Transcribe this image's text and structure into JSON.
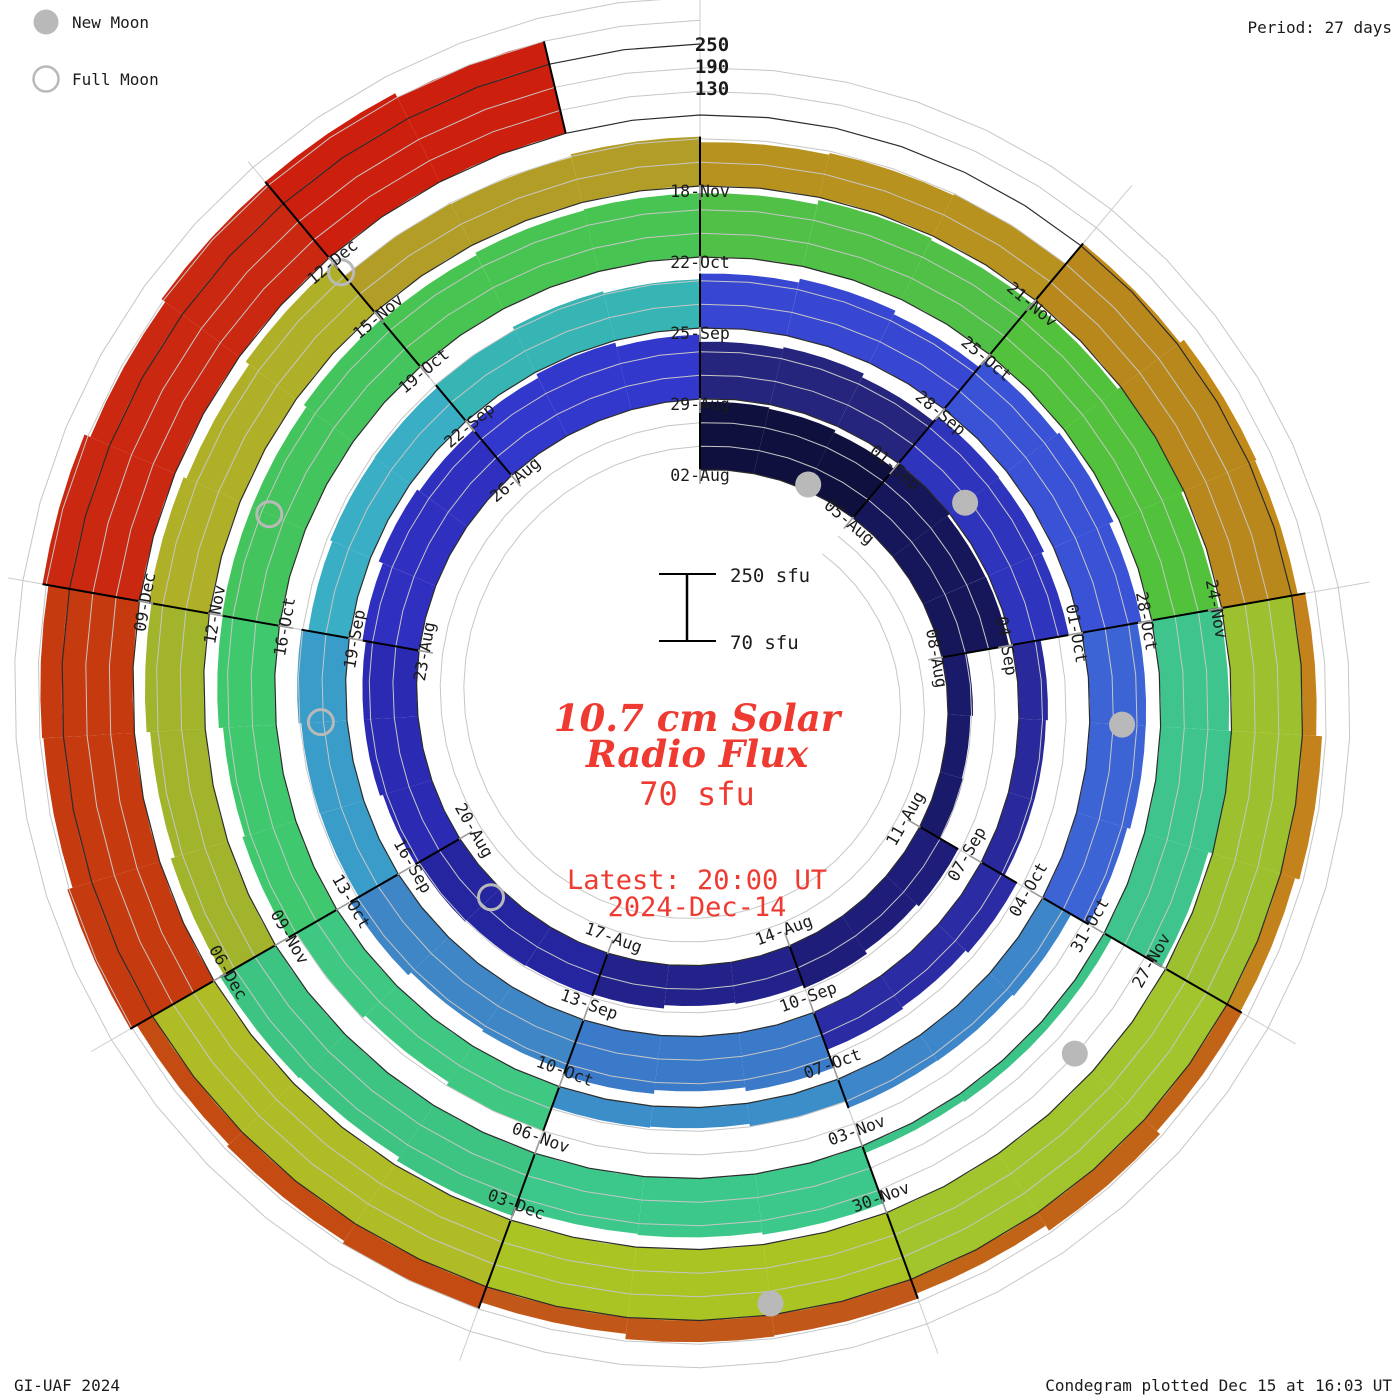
{
  "legend": {
    "new_moon_label": "New Moon",
    "full_moon_label": "Full Moon"
  },
  "period_label": "Period: 27 days",
  "radial_scale_labels": [
    "250",
    "190",
    "130"
  ],
  "scalebar": {
    "top_label": "250 sfu",
    "bottom_label": "70 sfu"
  },
  "center": {
    "title_line1": "10.7 cm Solar",
    "title_line2": "Radio Flux",
    "flux_value": "70 sfu",
    "latest_line1": "Latest: 20:00 UT",
    "latest_line2": "2024-Dec-14"
  },
  "footer": {
    "credit": "GI-UAF 2024",
    "plotted": "Condegram plotted Dec 15 at 16:03 UT"
  },
  "colors": {
    "text": "#1b1b1b",
    "red_text": "#ee3a31",
    "grid": "#c6c6c6",
    "baseline": "#2b2b2b",
    "separator": "#000000",
    "spoke": "#cccccc",
    "tick": "#9a9a9a",
    "moon": "#b9b9b9"
  },
  "chart_data": {
    "type": "bar",
    "subtype": "spiral-condegram",
    "title": "10.7 cm Solar Radio Flux",
    "period_days": 27,
    "days_per_block": 3,
    "start_date": "2024-08-02",
    "end_date": "2024-12-14",
    "flux_baseline_sfu": 70,
    "flux_gridlines_sfu": [
      130,
      190,
      250
    ],
    "layout": {
      "clockwise": true,
      "start_angle_deg": 0,
      "legend_position": "top-left",
      "grid": true
    },
    "blocks": [
      {
        "date": "02-Aug",
        "flux_sfu": 238,
        "color": "#10103e"
      },
      {
        "date": "05-Aug",
        "flux_sfu": 245,
        "color": "#16165a"
      },
      {
        "date": "08-Aug",
        "flux_sfu": 130,
        "color": "#1a1a6a"
      },
      {
        "date": "11-Aug",
        "flux_sfu": 180,
        "color": "#1e1e7a"
      },
      {
        "date": "14-Aug",
        "flux_sfu": 176,
        "color": "#22228a"
      },
      {
        "date": "17-Aug",
        "flux_sfu": 188,
        "color": "#2525a0"
      },
      {
        "date": "20-Aug",
        "flux_sfu": 205,
        "color": "#2a2ab2"
      },
      {
        "date": "23-Aug",
        "flux_sfu": 222,
        "color": "#2f2fc0"
      },
      {
        "date": "26-Aug",
        "flux_sfu": 238,
        "color": "#3338cc"
      },
      {
        "date": "29-Aug",
        "flux_sfu": 215,
        "color": "#25257e"
      },
      {
        "date": "01-Sep",
        "flux_sfu": 222,
        "color": "#2e34bc"
      },
      {
        "date": "04-Sep",
        "flux_sfu": 140,
        "color": "#29299c"
      },
      {
        "date": "07-Sep",
        "flux_sfu": 170,
        "color": "#2b2ba4"
      },
      {
        "date": "10-Sep",
        "flux_sfu": 215,
        "color": "#3a7ac8"
      },
      {
        "date": "13-Sep",
        "flux_sfu": 205,
        "color": "#3e86c6"
      },
      {
        "date": "16-Sep",
        "flux_sfu": 188,
        "color": "#3a9cc8"
      },
      {
        "date": "19-Sep",
        "flux_sfu": 180,
        "color": "#3aaec4"
      },
      {
        "date": "22-Sep",
        "flux_sfu": 194,
        "color": "#37b4b4"
      },
      {
        "date": "25-Sep",
        "flux_sfu": 212,
        "color": "#3747d2"
      },
      {
        "date": "28-Sep",
        "flux_sfu": 230,
        "color": "#3952d6"
      },
      {
        "date": "01-Oct",
        "flux_sfu": 210,
        "color": "#3c64d4"
      },
      {
        "date": "04-Oct",
        "flux_sfu": 150,
        "color": "#3e86ca"
      },
      {
        "date": "07-Oct",
        "flux_sfu": 125,
        "color": "#3c8ec8"
      },
      {
        "date": "10-Oct",
        "flux_sfu": 185,
        "color": "#3ec882"
      },
      {
        "date": "13-Oct",
        "flux_sfu": 210,
        "color": "#40c86e"
      },
      {
        "date": "16-Oct",
        "flux_sfu": 220,
        "color": "#44c45c"
      },
      {
        "date": "19-Oct",
        "flux_sfu": 228,
        "color": "#48c452"
      },
      {
        "date": "22-Oct",
        "flux_sfu": 238,
        "color": "#50c046"
      },
      {
        "date": "25-Oct",
        "flux_sfu": 246,
        "color": "#52c23c"
      },
      {
        "date": "28-Oct",
        "flux_sfu": 245,
        "color": "#3ec48c"
      },
      {
        "date": "31-Oct",
        "flux_sfu": 92,
        "color": "#3cc488"
      },
      {
        "date": "03-Nov",
        "flux_sfu": 220,
        "color": "#3cc88a"
      },
      {
        "date": "06-Nov",
        "flux_sfu": 232,
        "color": "#3ec482"
      },
      {
        "date": "09-Nov",
        "flux_sfu": 216,
        "color": "#a2b42c"
      },
      {
        "date": "12-Nov",
        "flux_sfu": 224,
        "color": "#b0b028"
      },
      {
        "date": "15-Nov",
        "flux_sfu": 190,
        "color": "#b29e26"
      },
      {
        "date": "18-Nov",
        "flux_sfu": 185,
        "color": "#b8921e"
      },
      {
        "date": "21-Nov",
        "flux_sfu": 265,
        "color": "#b8881c",
        "overflow_color": "#c28a18"
      },
      {
        "date": "24-Nov",
        "flux_sfu": 292,
        "color": "#9cc02e",
        "overflow_color": "#c4821c"
      },
      {
        "date": "27-Nov",
        "flux_sfu": 296,
        "color": "#a2c42c",
        "overflow_color": "#c26418"
      },
      {
        "date": "30-Nov",
        "flux_sfu": 300,
        "color": "#aac424",
        "overflow_color": "#c2571a"
      },
      {
        "date": "03-Dec",
        "flux_sfu": 302,
        "color": "#b0bc26",
        "overflow_color": "#c44c12"
      },
      {
        "date": "06-Dec",
        "flux_sfu": 306,
        "color": "#c63a10",
        "overflow_color": "#c63a10"
      },
      {
        "date": "09-Dec",
        "flux_sfu": 312,
        "color": "#ca2810",
        "overflow_color": "#ca2810"
      },
      {
        "date": "12-Dec",
        "flux_sfu": 318,
        "color": "#cc1f0e",
        "overflow_color": "#cc1f0e"
      }
    ],
    "moons": {
      "new_moons": [
        {
          "date": "2024-Aug-04",
          "day": 2
        },
        {
          "date": "2024-Sep-03",
          "day": 31
        },
        {
          "date": "2024-Oct-02",
          "day": 61
        },
        {
          "date": "2024-Nov-01",
          "day": 91
        },
        {
          "date": "2024-Dec-01",
          "day": 121
        }
      ],
      "full_moons": [
        {
          "date": "2024-Aug-19",
          "day": 17
        },
        {
          "date": "2024-Sep-18",
          "day": 47
        },
        {
          "date": "2024-Oct-17",
          "day": 76
        },
        {
          "date": "2024-Nov-15",
          "day": 105
        }
      ]
    }
  }
}
